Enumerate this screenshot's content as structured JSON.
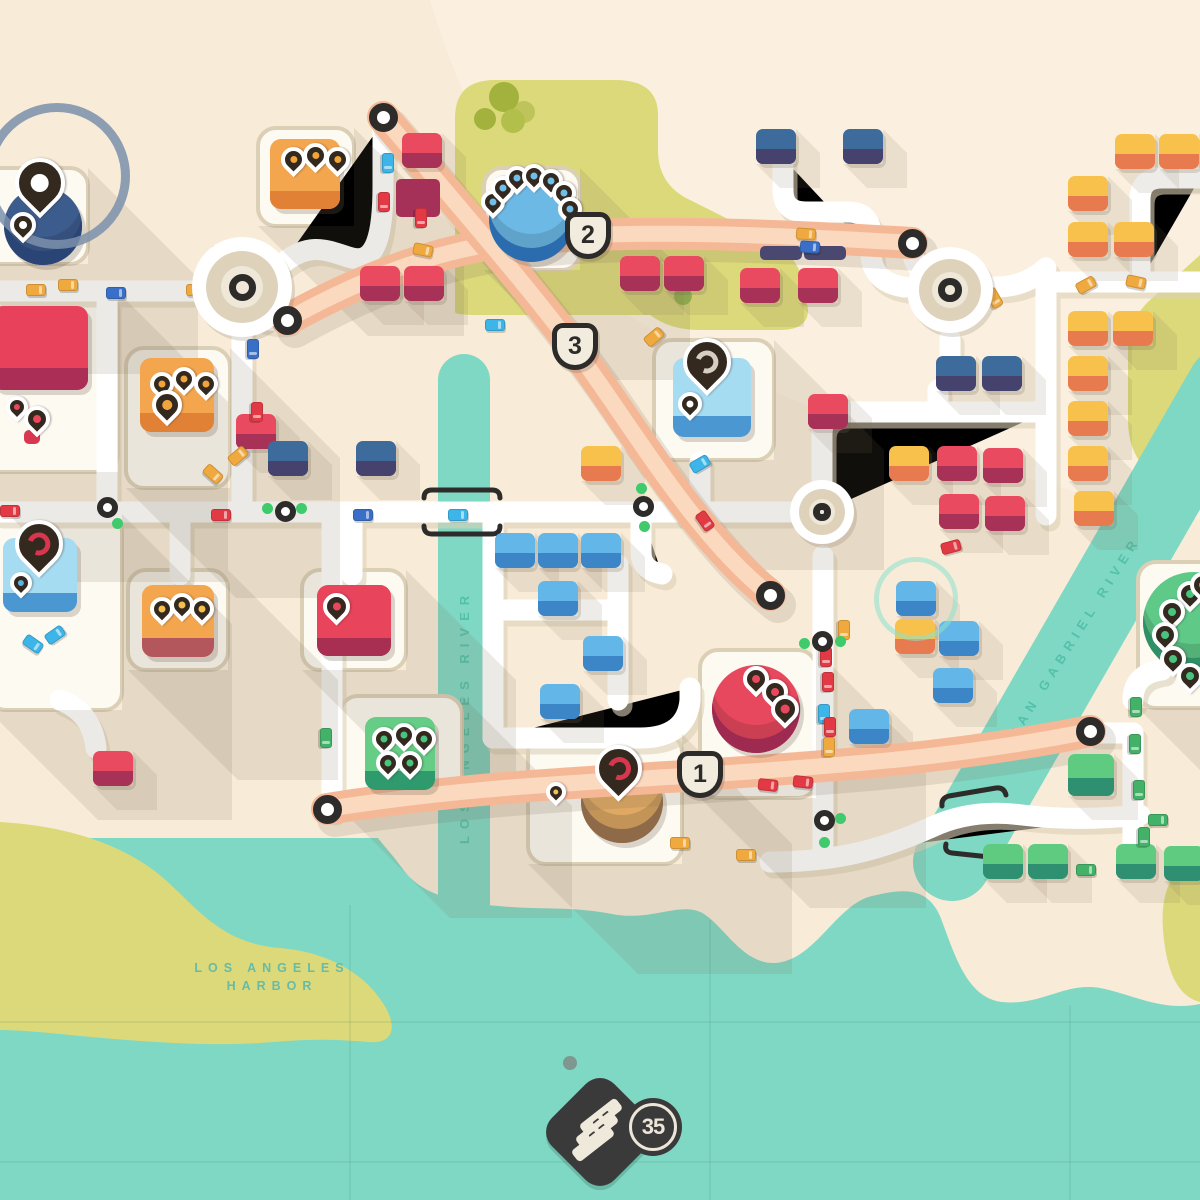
{
  "hud": {
    "score": "35"
  },
  "labels": {
    "harbor1": "LOS ANGELES",
    "harbor2": "HARBOR",
    "la_river": "LOS ANGELES RIVER",
    "sg_river": "SAN GABRIEL RIVER"
  },
  "highway_badges": [
    {
      "label": "2",
      "x": 588,
      "y": 236
    },
    {
      "label": "3",
      "x": 575,
      "y": 347
    },
    {
      "label": "1",
      "x": 700,
      "y": 775
    }
  ],
  "palette": {
    "land": "#f8ecd8",
    "land_light": "#fdf4e6",
    "water": "#7fd8c4",
    "park": "#dcd97a",
    "road": "#ffffff",
    "road_shadow": "#ddd1b8",
    "plot_fill": "#fdfaf2",
    "plot_stroke": "#dbcfb6",
    "highway": "#f5b897",
    "highway_stripe": "#fbd9bf",
    "outline_dark": "#2d2c2a",
    "traffic_green": "#3fca6b",
    "house_colors": {
      "red": [
        "#ea4a5f",
        "#a83157"
      ],
      "blue": [
        "#62b6e8",
        "#3c86c8"
      ],
      "darkblue": [
        "#3c6b9c",
        "#45426e"
      ],
      "orange": [
        "#f7c14c",
        "#e87a50"
      ],
      "green": [
        "#5ecb81",
        "#2e9070"
      ]
    },
    "car_colors": {
      "yellow": "#efa93e",
      "red": "#e23a44",
      "cyan": "#3db5e8",
      "blue": "#3a6fc8",
      "green": "#43b168"
    }
  },
  "map": {
    "houses": [
      [
        "red",
        402,
        133
      ],
      [
        "red",
        360,
        266
      ],
      [
        "red",
        404,
        266
      ],
      [
        "red",
        620,
        256
      ],
      [
        "red",
        664,
        256
      ],
      [
        "red",
        740,
        268
      ],
      [
        "red",
        798,
        268
      ],
      [
        "red",
        808,
        394
      ],
      [
        "red",
        937,
        446
      ],
      [
        "red",
        983,
        448
      ],
      [
        "red",
        939,
        494
      ],
      [
        "red",
        985,
        496
      ],
      [
        "red",
        236,
        414
      ],
      [
        "red",
        93,
        751
      ],
      [
        "darkblue",
        756,
        129
      ],
      [
        "darkblue",
        843,
        129
      ],
      [
        "darkblue",
        268,
        441
      ],
      [
        "darkblue",
        356,
        441
      ],
      [
        "darkblue",
        936,
        356
      ],
      [
        "darkblue",
        982,
        356
      ],
      [
        "blue",
        495,
        533
      ],
      [
        "blue",
        538,
        533
      ],
      [
        "blue",
        581,
        533
      ],
      [
        "blue",
        538,
        581
      ],
      [
        "blue",
        583,
        636
      ],
      [
        "blue",
        540,
        684
      ],
      [
        "blue",
        896,
        581
      ],
      [
        "blue",
        939,
        621
      ],
      [
        "blue",
        933,
        668
      ],
      [
        "blue",
        849,
        709
      ],
      [
        "orange",
        1115,
        134
      ],
      [
        "orange",
        1159,
        134
      ],
      [
        "orange",
        1068,
        176
      ],
      [
        "orange",
        1068,
        222
      ],
      [
        "orange",
        1114,
        222
      ],
      [
        "orange",
        1068,
        311
      ],
      [
        "orange",
        1113,
        311
      ],
      [
        "orange",
        1068,
        356
      ],
      [
        "orange",
        1068,
        401
      ],
      [
        "orange",
        1068,
        446
      ],
      [
        "orange",
        1074,
        491
      ],
      [
        "orange",
        581,
        446
      ],
      [
        "orange",
        895,
        619
      ],
      [
        "orange",
        889,
        446
      ],
      [
        "green",
        1068,
        754,
        46,
        42
      ],
      [
        "green",
        983,
        844
      ],
      [
        "green",
        1028,
        844
      ],
      [
        "green",
        1116,
        844
      ],
      [
        "green",
        1164,
        846
      ]
    ],
    "shadow_houses": [
      [
        396,
        179,
        44,
        38,
        "#a63158"
      ],
      [
        760,
        246,
        42,
        14,
        "#4a4870"
      ],
      [
        804,
        246,
        42,
        14,
        "#4a4870"
      ],
      [
        24,
        430,
        16,
        14,
        "#d8374f"
      ]
    ],
    "cars": [
      [
        "yellow",
        26,
        284,
        0
      ],
      [
        "blue",
        106,
        287,
        0
      ],
      [
        "yellow",
        186,
        284,
        0
      ],
      [
        "cyan",
        236,
        287,
        0
      ],
      [
        "yellow",
        58,
        279,
        0
      ],
      [
        "red",
        210,
        248,
        20
      ],
      [
        "yellow",
        221,
        306,
        -25
      ],
      [
        "red",
        374,
        196,
        90
      ],
      [
        "cyan",
        378,
        157,
        90
      ],
      [
        "red",
        411,
        212,
        90
      ],
      [
        "yellow",
        413,
        244,
        12
      ],
      [
        "yellow",
        796,
        228,
        4
      ],
      [
        "blue",
        800,
        241,
        4
      ],
      [
        "blue",
        929,
        256,
        -40
      ],
      [
        "yellow",
        984,
        292,
        60
      ],
      [
        "yellow",
        1076,
        279,
        -28
      ],
      [
        "yellow",
        1126,
        276,
        12
      ],
      [
        "blue",
        243,
        343,
        90
      ],
      [
        "red",
        247,
        406,
        90
      ],
      [
        "yellow",
        203,
        468,
        42
      ],
      [
        "yellow",
        228,
        450,
        -40
      ],
      [
        "red",
        0,
        505,
        0
      ],
      [
        "red",
        211,
        509,
        0
      ],
      [
        "blue",
        353,
        509,
        0
      ],
      [
        "cyan",
        448,
        509,
        0
      ],
      [
        "cyan",
        485,
        319,
        0
      ],
      [
        "cyan",
        690,
        458,
        -30
      ],
      [
        "yellow",
        644,
        331,
        -40
      ],
      [
        "red",
        695,
        515,
        55
      ],
      [
        "cyan",
        23,
        638,
        35
      ],
      [
        "cyan",
        45,
        629,
        -35
      ],
      [
        "red",
        941,
        541,
        -15
      ],
      [
        "yellow",
        834,
        624,
        90
      ],
      [
        "red",
        816,
        651,
        90
      ],
      [
        "red",
        818,
        676,
        90
      ],
      [
        "cyan",
        814,
        708,
        90
      ],
      [
        "red",
        820,
        721,
        90
      ],
      [
        "yellow",
        819,
        741,
        90
      ],
      [
        "green",
        316,
        732,
        90
      ],
      [
        "red",
        758,
        779,
        6
      ],
      [
        "red",
        793,
        776,
        6
      ],
      [
        "yellow",
        736,
        849,
        0
      ],
      [
        "yellow",
        670,
        837,
        0
      ],
      [
        "green",
        1126,
        701,
        90
      ],
      [
        "green",
        1125,
        738,
        90
      ],
      [
        "green",
        1129,
        784,
        90
      ],
      [
        "green",
        1134,
        831,
        90
      ],
      [
        "green",
        1148,
        814,
        0
      ],
      [
        "green",
        1076,
        864,
        0
      ]
    ],
    "traffic_lights": [
      {
        "x": 107,
        "y": 507,
        "dots": [
          [
            117,
            523
          ]
        ]
      },
      {
        "x": 285,
        "y": 511,
        "dots": [
          [
            267,
            508
          ],
          [
            301,
            508
          ]
        ]
      },
      {
        "x": 643,
        "y": 506,
        "dots": [
          [
            641,
            488
          ],
          [
            644,
            526
          ]
        ]
      },
      {
        "x": 822,
        "y": 641,
        "dots": [
          [
            840,
            641
          ],
          [
            804,
            643
          ]
        ]
      },
      {
        "x": 824,
        "y": 820,
        "dots": [
          [
            840,
            818
          ],
          [
            824,
            842
          ]
        ]
      }
    ],
    "highway_rings": [
      [
        383,
        117
      ],
      [
        770,
        595
      ],
      [
        287,
        320
      ],
      [
        912,
        243
      ],
      [
        327,
        809
      ],
      [
        1090,
        731
      ]
    ],
    "roundabouts": [
      {
        "x": 242,
        "y": 287,
        "d": 100
      },
      {
        "x": 950,
        "y": 290,
        "d": 86
      },
      {
        "x": 822,
        "y": 512,
        "d": 64
      }
    ],
    "spawn_ring": {
      "x": 916,
      "y": 599,
      "d": 84
    },
    "destinations": [
      {
        "id": "landmark-pin-monument",
        "shape": "circle",
        "cx": 43,
        "cy": 226,
        "d": 78,
        "fill": "#3d5c8e",
        "inset": "#2a4575",
        "plot": [
          -40,
          168,
          128,
          96
        ],
        "ring": {
          "cx": 57,
          "cy": 176,
          "d": 146
        },
        "pins": [
          {
            "x": 15,
            "y": 158,
            "s": 50,
            "dot": "#ffffff"
          },
          {
            "x": 10,
            "y": 212,
            "s": 26,
            "dot": "#ffffff"
          }
        ]
      },
      {
        "id": "orange-store-north",
        "shape": "square",
        "x": 270,
        "y": 139,
        "w": 70,
        "h": 70,
        "fill": "#f4a64f",
        "base": "#e08136",
        "plot": [
          258,
          128,
          96,
          98
        ],
        "pins": [
          {
            "x": 281,
            "y": 147,
            "s": 25,
            "dot": "#f0a43c"
          },
          {
            "x": 303,
            "y": 143,
            "s": 25,
            "dot": "#f0a43c"
          },
          {
            "x": 325,
            "y": 147,
            "s": 25,
            "dot": "#f0a43c"
          }
        ]
      },
      {
        "id": "blue-round-hub",
        "shape": "circle",
        "cx": 531,
        "cy": 219,
        "d": 85,
        "fill": "#6db9e6",
        "inset": "#2b6cae",
        "plot": [
          484,
          168,
          96,
          102
        ],
        "pins": [
          {
            "x": 481,
            "y": 190,
            "s": 24,
            "dot": "#6fbfe8"
          },
          {
            "x": 491,
            "y": 176,
            "s": 24,
            "dot": "#6fbfe8"
          },
          {
            "x": 505,
            "y": 166,
            "s": 24,
            "dot": "#6fbfe8"
          },
          {
            "x": 522,
            "y": 164,
            "s": 24,
            "dot": "#6fbfe8"
          },
          {
            "x": 539,
            "y": 169,
            "s": 24,
            "dot": "#6fbfe8"
          },
          {
            "x": 552,
            "y": 181,
            "s": 24,
            "dot": "#6fbfe8"
          },
          {
            "x": 558,
            "y": 197,
            "s": 24,
            "dot": "#6fbfe8"
          }
        ]
      },
      {
        "id": "orange-store-west",
        "shape": "square",
        "x": 140,
        "y": 358,
        "w": 74,
        "h": 74,
        "fill": "#f4a64f",
        "base": "#e08136",
        "plot": [
          126,
          348,
          104,
          140
        ],
        "pins": [
          {
            "x": 150,
            "y": 372,
            "s": 24,
            "dot": "#f0a43c"
          },
          {
            "x": 172,
            "y": 367,
            "s": 24,
            "dot": "#f0a43c"
          },
          {
            "x": 194,
            "y": 372,
            "s": 24,
            "dot": "#f0a43c"
          },
          {
            "x": 152,
            "y": 390,
            "s": 30,
            "dot": "#f0a43c"
          }
        ]
      },
      {
        "id": "red-block-west",
        "shape": "square",
        "x": -8,
        "y": 306,
        "w": 96,
        "h": 84,
        "fill": "#e8415c",
        "base": "#aa2e55",
        "plot": [
          -34,
          292,
          152,
          180
        ],
        "pins": [
          {
            "x": 6,
            "y": 396,
            "s": 22,
            "dot": "#e8485e"
          },
          {
            "x": 24,
            "y": 406,
            "s": 26,
            "dot": "#e8485e"
          }
        ]
      },
      {
        "id": "blue-pin-depot-west",
        "shape": "square",
        "x": 3,
        "y": 538,
        "w": 74,
        "h": 74,
        "fill": "#a6dcf2",
        "base": "#4a97d1",
        "plot": [
          -12,
          514,
          134,
          196
        ],
        "pins": [
          {
            "x": 15,
            "y": 520,
            "s": 48,
            "ring": "#d8354f"
          },
          {
            "x": 10,
            "y": 572,
            "s": 22,
            "dot": "#5ab4e4"
          }
        ]
      },
      {
        "id": "orange-store-south",
        "shape": "square",
        "x": 142,
        "y": 585,
        "w": 72,
        "h": 72,
        "fill": "#f4a64f",
        "base": "#b4575c",
        "plot": [
          128,
          570,
          100,
          100
        ],
        "pins": [
          {
            "x": 150,
            "y": 597,
            "s": 24,
            "dot": "#f5c04e"
          },
          {
            "x": 170,
            "y": 593,
            "s": 24,
            "dot": "#f5c04e"
          },
          {
            "x": 190,
            "y": 597,
            "s": 24,
            "dot": "#f5c04e"
          }
        ]
      },
      {
        "id": "red-store-mid",
        "shape": "square",
        "x": 317,
        "y": 585,
        "w": 74,
        "h": 71,
        "fill": "#e8445c",
        "base": "#a82e52",
        "plot": [
          302,
          570,
          104,
          100
        ],
        "pins": [
          {
            "x": 323,
            "y": 593,
            "s": 27,
            "dot": "#e8485e"
          }
        ]
      },
      {
        "id": "green-store-south",
        "shape": "square",
        "x": 365,
        "y": 717,
        "w": 70,
        "h": 73,
        "fill": "#66cd86",
        "base": "#2f9a6e",
        "plot": [
          340,
          696,
          122,
          112
        ],
        "pins": [
          {
            "x": 372,
            "y": 727,
            "s": 24,
            "dot": "#49c47e"
          },
          {
            "x": 392,
            "y": 723,
            "s": 24,
            "dot": "#49c47e"
          },
          {
            "x": 412,
            "y": 727,
            "s": 24,
            "dot": "#49c47e"
          },
          {
            "x": 376,
            "y": 751,
            "s": 24,
            "dot": "#49c47e"
          },
          {
            "x": 398,
            "y": 751,
            "s": 24,
            "dot": "#49c47e"
          }
        ]
      },
      {
        "id": "blue-pin-depot-center",
        "shape": "square",
        "x": 673,
        "y": 358,
        "w": 78,
        "h": 79,
        "fill": "#a6dcf2",
        "base": "#4a97d1",
        "plot": [
          654,
          340,
          120,
          120
        ],
        "pins": [
          {
            "x": 683,
            "y": 338,
            "s": 48,
            "ring": "#d6cec2"
          },
          {
            "x": 678,
            "y": 392,
            "s": 24,
            "dot": "#ffffff"
          }
        ]
      },
      {
        "id": "red-round-plant",
        "shape": "circle",
        "cx": 756,
        "cy": 709,
        "d": 88,
        "fill": "#e8485e",
        "inset": "#9e2a52",
        "plot": [
          700,
          650,
          116,
          148
        ],
        "pins": [
          {
            "x": 743,
            "y": 666,
            "s": 26,
            "dot": "#e8485e"
          },
          {
            "x": 762,
            "y": 679,
            "s": 26,
            "dot": "#e8485e"
          },
          {
            "x": 771,
            "y": 695,
            "s": 28,
            "dot": "#e8485e"
          }
        ]
      },
      {
        "id": "amber-round-depot",
        "shape": "circle",
        "cx": 622,
        "cy": 802,
        "d": 82,
        "under": true,
        "fill": "#dfa963",
        "inset": "#8f6a48",
        "plot": [
          528,
          734,
          154,
          130
        ],
        "pins": [
          {
            "x": 595,
            "y": 745,
            "s": 47,
            "ring": "#d8354f"
          },
          {
            "x": 546,
            "y": 782,
            "s": 20,
            "dot": "#f0c35c"
          }
        ]
      },
      {
        "id": "green-round-hub-east",
        "shape": "circle",
        "cx": 1193,
        "cy": 622,
        "d": 100,
        "fill": "#5fc988",
        "inset": "#2f8f66",
        "plot": [
          1138,
          562,
          94,
          146
        ],
        "pins": [
          {
            "x": 1177,
            "y": 581,
            "s": 26,
            "dot": "#49c47e"
          },
          {
            "x": 1159,
            "y": 599,
            "s": 26,
            "dot": "#49c47e"
          },
          {
            "x": 1152,
            "y": 622,
            "s": 26,
            "dot": "#49c47e"
          },
          {
            "x": 1160,
            "y": 646,
            "s": 26,
            "dot": "#49c47e"
          },
          {
            "x": 1177,
            "y": 663,
            "s": 26,
            "dot": "#49c47e"
          },
          {
            "x": 1190,
            "y": 572,
            "s": 26,
            "dot": "#49c47e"
          }
        ]
      }
    ]
  }
}
